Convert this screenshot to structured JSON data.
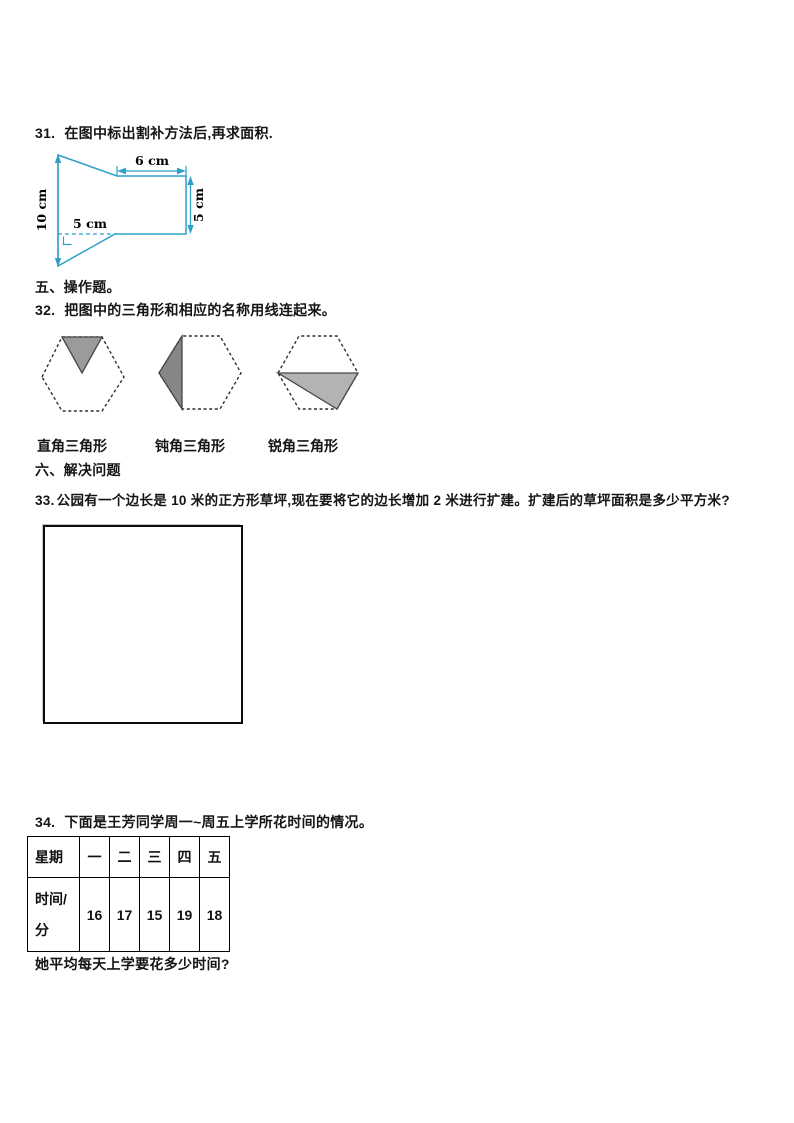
{
  "colors": {
    "figure_line": "#2e9fc7",
    "hex_border": "#2f2f2f",
    "triangle_fill_1": "#9b9b9b",
    "triangle_fill_2": "#868686",
    "triangle_fill_3": "#b3b3b3",
    "triangle_stroke": "#474747"
  },
  "q31": {
    "number": "31.",
    "text": "在图中标出割补方法后,再求面积.",
    "figure_dims": {
      "left": "10 cm",
      "top": "6 cm",
      "right": "5 cm",
      "bottom": "5 cm"
    }
  },
  "section_five": {
    "title": "五、操作题。"
  },
  "q32": {
    "number": "32.",
    "text": "把图中的三角形和相应的名称用线连起来。",
    "labels": [
      "直角三角形",
      "钝角三角形",
      "锐角三角形"
    ]
  },
  "section_six": {
    "title": "六、解决问题"
  },
  "q33": {
    "number": "33.",
    "text": "公园有一个边长是 10 米的正方形草坪,现在要将它的边长增加 2 米进行扩建。扩建后的草坪面积是多少平方米?"
  },
  "q34": {
    "number": "34.",
    "text": "下面是王芳同学周一~周五上学所花时间的情况。",
    "table": {
      "headers": [
        "星期",
        "一",
        "二",
        "三",
        "四",
        "五"
      ],
      "row_label": "时间/分",
      "values": [
        "16",
        "17",
        "15",
        "19",
        "18"
      ]
    },
    "question": "她平均每天上学要花多少时间?"
  }
}
